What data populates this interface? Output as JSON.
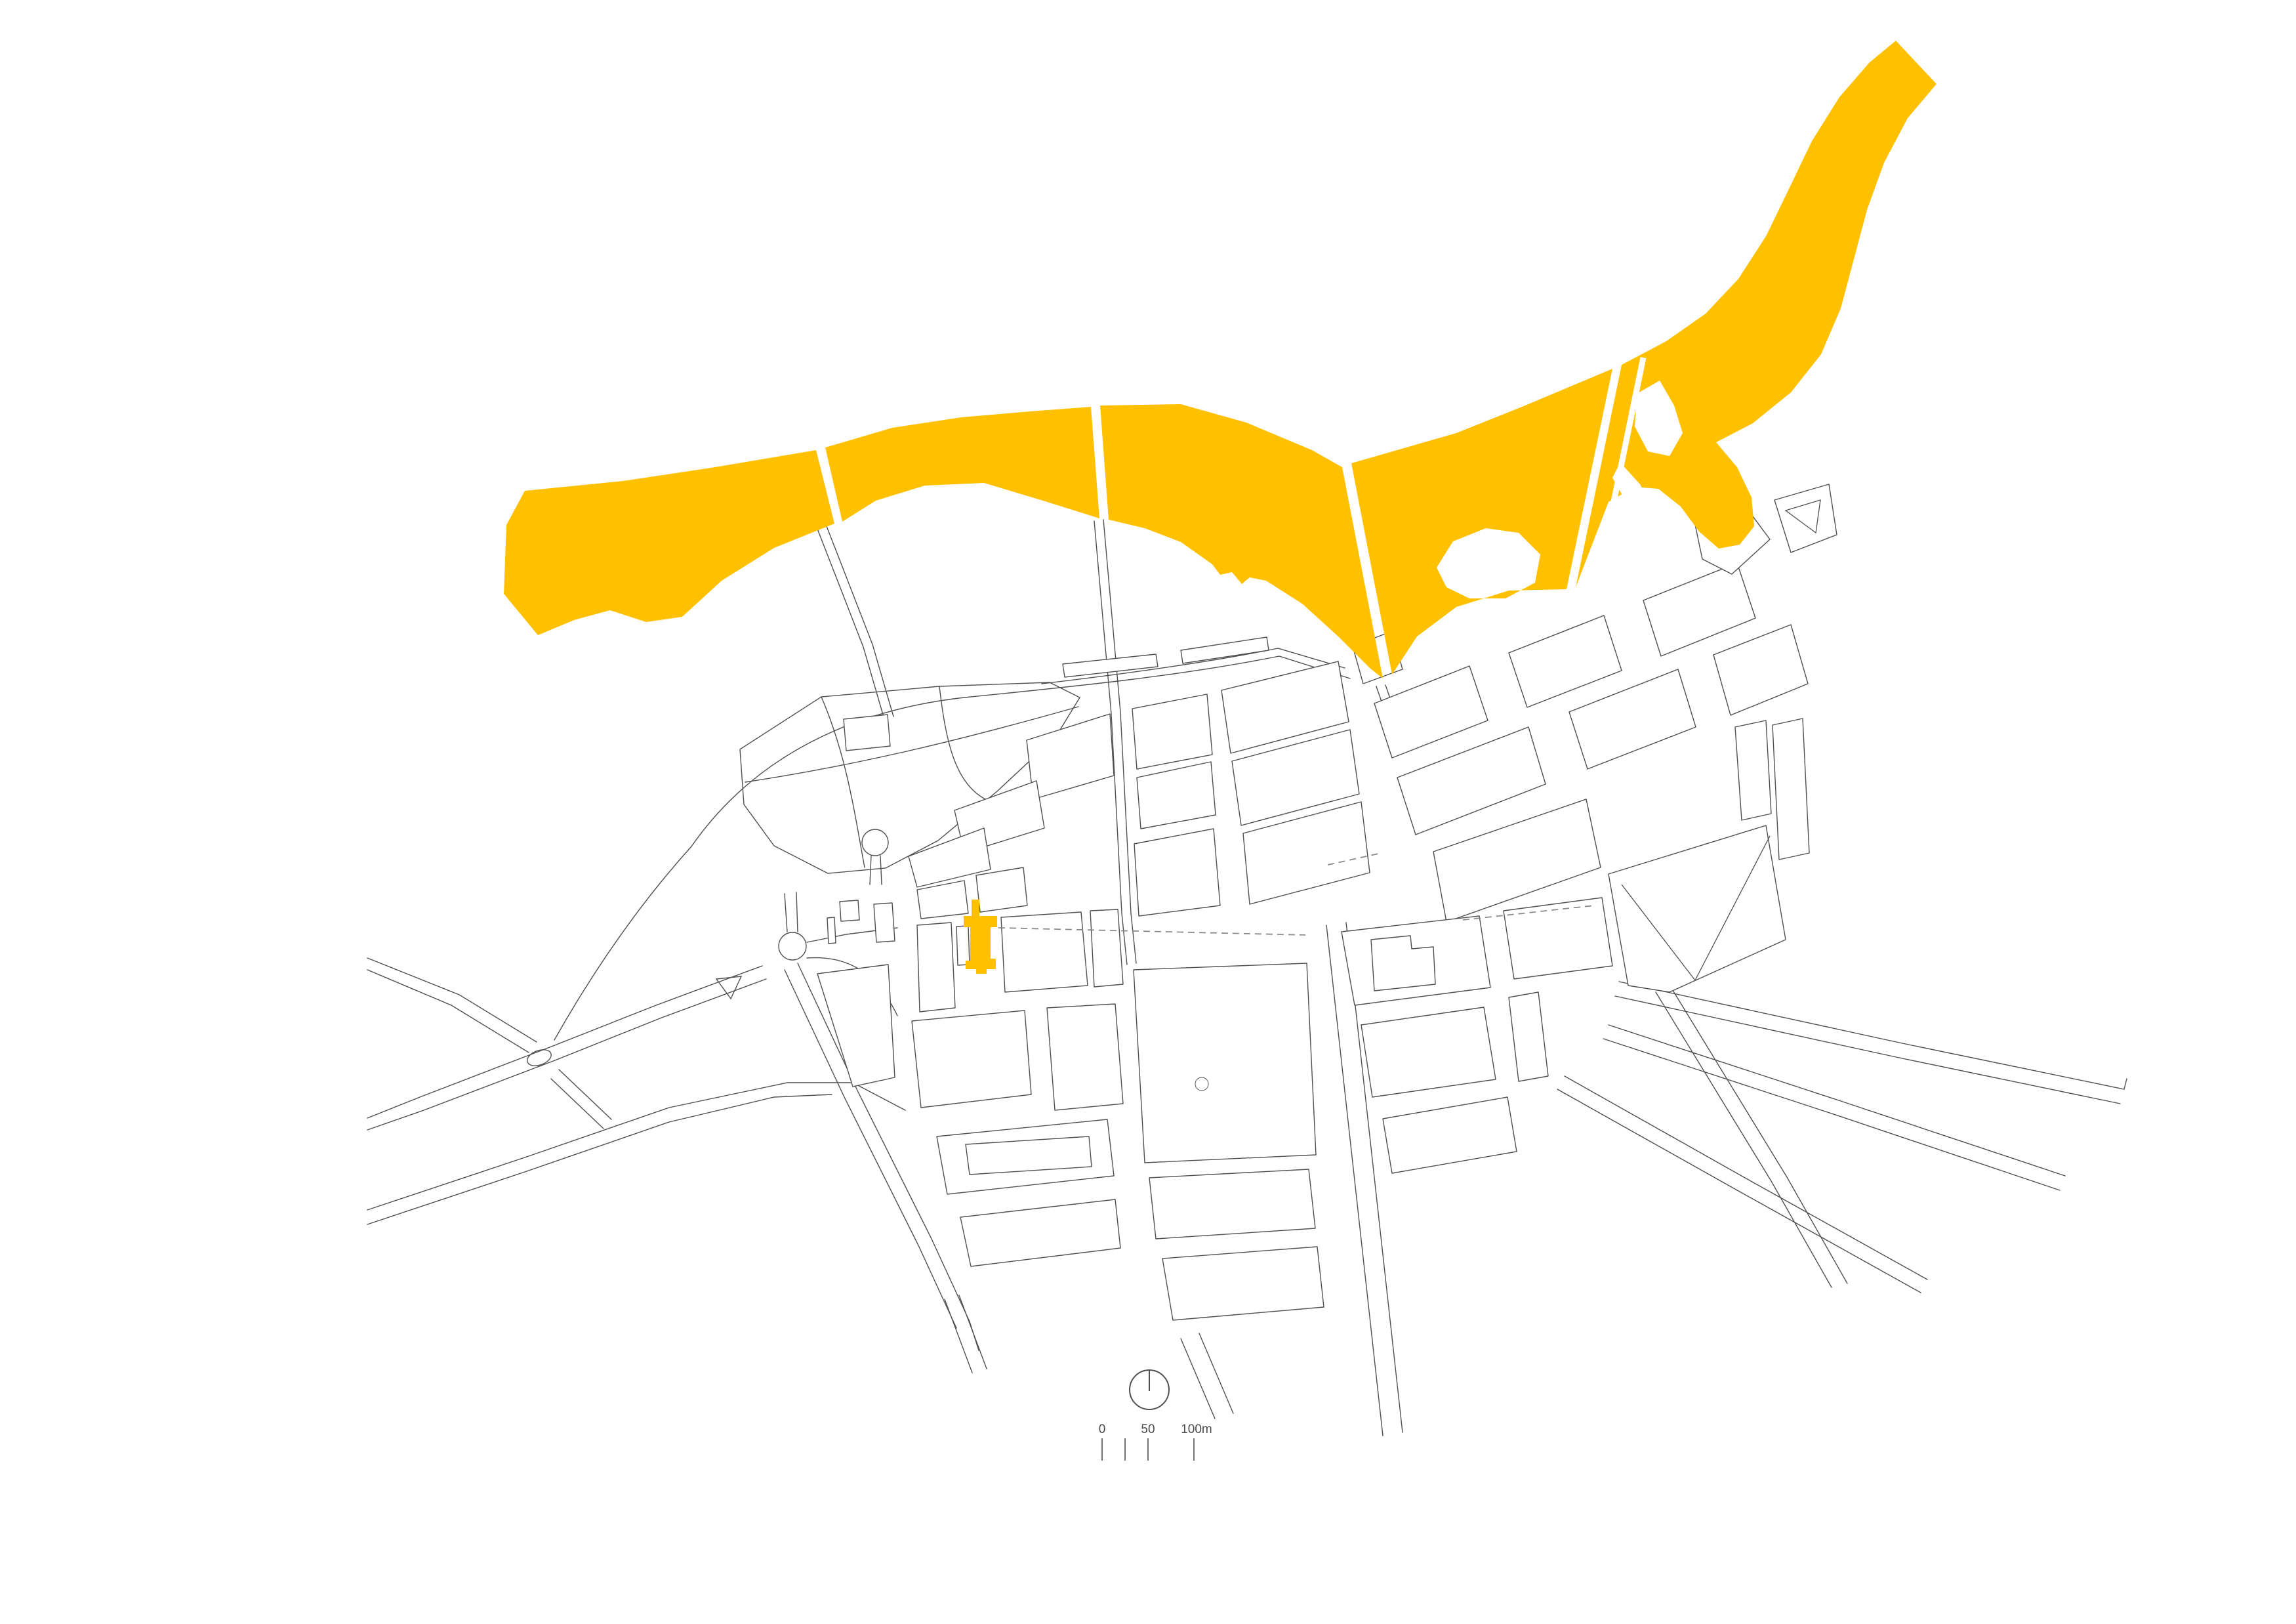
{
  "page": {
    "background_color": "#ffffff"
  },
  "map": {
    "type": "architectural-site-location-plan",
    "colors": {
      "highlight": "#ffc000",
      "linework": "#4f4f4f",
      "dashed": "#8a8a8a",
      "background": "#ffffff"
    },
    "features": {
      "river": "river highlighted in yellow flowing west to northeast with bridge gaps and islands",
      "site_marker": "project site highlighted in yellow within city block fabric",
      "city_fabric": "figure-ground plan of urban blocks drawn in thin grey outline",
      "dashed_route": "dashed alignment line running east from the site",
      "north_arrow": "circle with vertical needle pointing up (north)"
    },
    "scale_bar": {
      "labels": [
        "0",
        "50",
        "100m"
      ],
      "tick_values_m": [
        0,
        25,
        50,
        100
      ],
      "unit": "m"
    }
  }
}
